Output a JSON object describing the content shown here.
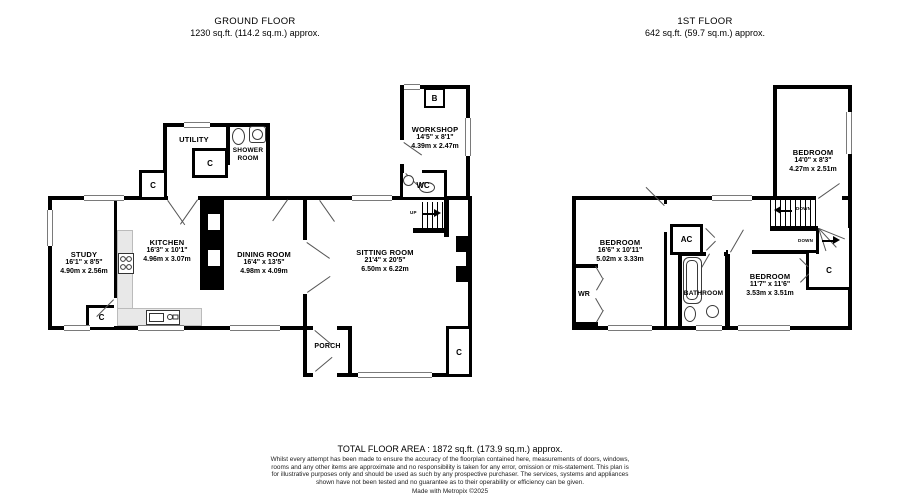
{
  "floors": {
    "ground": {
      "title": "GROUND FLOOR",
      "area": "1230 sq.ft. (114.2 sq.m.) approx.",
      "rooms": {
        "study": {
          "name": "STUDY",
          "imperial": "16'1\" x 8'5\"",
          "metric": "4.90m x 2.56m"
        },
        "kitchen": {
          "name": "KITCHEN",
          "imperial": "16'3\" x 10'1\"",
          "metric": "4.96m x 3.07m"
        },
        "dining": {
          "name": "DINING ROOM",
          "imperial": "16'4\" x 13'5\"",
          "metric": "4.98m x 4.09m"
        },
        "sitting": {
          "name": "SITTING ROOM",
          "imperial": "21'4\" x 20'5\"",
          "metric": "6.50m x 6.22m"
        },
        "workshop": {
          "name": "WORKSHOP",
          "imperial": "14'5\" x 8'1\"",
          "metric": "4.39m x 2.47m"
        },
        "utility": {
          "name": "UTILITY"
        },
        "shower": {
          "name": "SHOWER ROOM"
        },
        "porch": {
          "name": "PORCH"
        },
        "wc": {
          "name": "WC"
        }
      },
      "labels": {
        "boiler": "B",
        "cupboard": "C",
        "up": "UP"
      }
    },
    "first": {
      "title": "1ST FLOOR",
      "area": "642 sq.ft. (59.7 sq.m.) approx.",
      "rooms": {
        "bedroom1": {
          "name": "BEDROOM",
          "imperial": "14'0\" x 8'3\"",
          "metric": "4.27m x 2.51m"
        },
        "bedroom2": {
          "name": "BEDROOM",
          "imperial": "16'6\" x 10'11\"",
          "metric": "5.02m x 3.33m"
        },
        "bedroom3": {
          "name": "BEDROOM",
          "imperial": "11'7\" x 11'6\"",
          "metric": "3.53m x 3.51m"
        },
        "bathroom": {
          "name": "BATHROOM"
        }
      },
      "labels": {
        "airing_cupboard": "AC",
        "wardrobe": "WR",
        "cupboard": "C",
        "down": "DOWN"
      }
    }
  },
  "footer": {
    "total": "TOTAL FLOOR AREA : 1872 sq.ft. (173.9 sq.m.) approx.",
    "disclaimer": "Whilst every attempt has been made to ensure the accuracy of the floorplan contained here, measurements of doors, windows, rooms and any other items are approximate and no responsibility is taken for any error, omission or mis-statement. This plan is for illustrative purposes only and should be used as such by any prospective purchaser. The services, systems and appliances shown have not been tested and no guarantee as to their operability or efficiency can be given.",
    "credit": "Made with Metropix ©2025"
  }
}
